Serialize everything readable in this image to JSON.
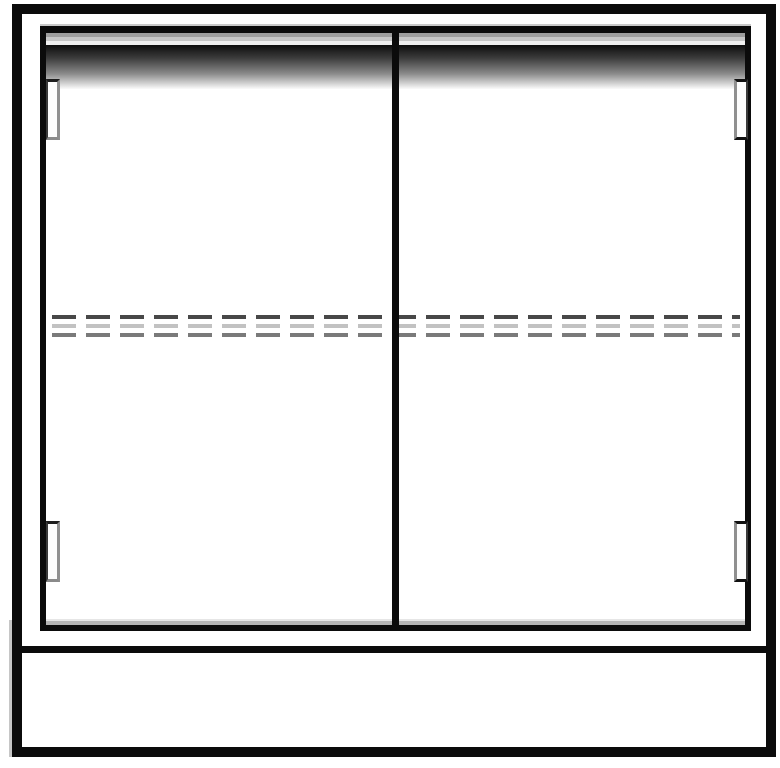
{
  "drawing": {
    "title": "two-door-cabinet-front-elevation",
    "parts": {
      "outer_frame": "cabinet carcass outline",
      "door_left": "left door panel",
      "door_right": "right door panel",
      "center_divider": "door meeting stile",
      "top_rail_shadow": "top rail shadow gradient band",
      "shelf_hidden_line_dark": "shelf hidden dashed line (dark)",
      "shelf_hidden_line_light": "shelf hidden dashed line (light)",
      "shelf_hidden_line_mid": "shelf hidden dashed line (mid gray)",
      "hinge_top_left": "top-left hinge",
      "hinge_bottom_left": "bottom-left hinge",
      "hinge_top_right": "top-right hinge",
      "hinge_bottom_right": "bottom-right hinge",
      "base_divider": "base separator line",
      "base_panel": "plinth base panel"
    },
    "colors": {
      "line_black": "#0b0b0b",
      "background": "#ffffff",
      "shadow_gradient_start": "#0d0d0d",
      "shadow_gradient_end": "#fbfbfb",
      "band_gray": "#9e9e9e",
      "band_light_gray": "#c6c6c6",
      "band_faint_gray": "#efefef",
      "trim_light": "#c9c9c9",
      "dash_dark": "#484848",
      "dash_light": "#c2c2c2",
      "dash_mid": "#7a7a7a",
      "inner_bottom_shadow": "#b5b5b5",
      "hinge_edge_dark": "#1c1c1c",
      "hinge_edge_gray": "#8f8f8f"
    },
    "dash_pattern": {
      "dash_px": 24,
      "gap_px": 10
    }
  }
}
